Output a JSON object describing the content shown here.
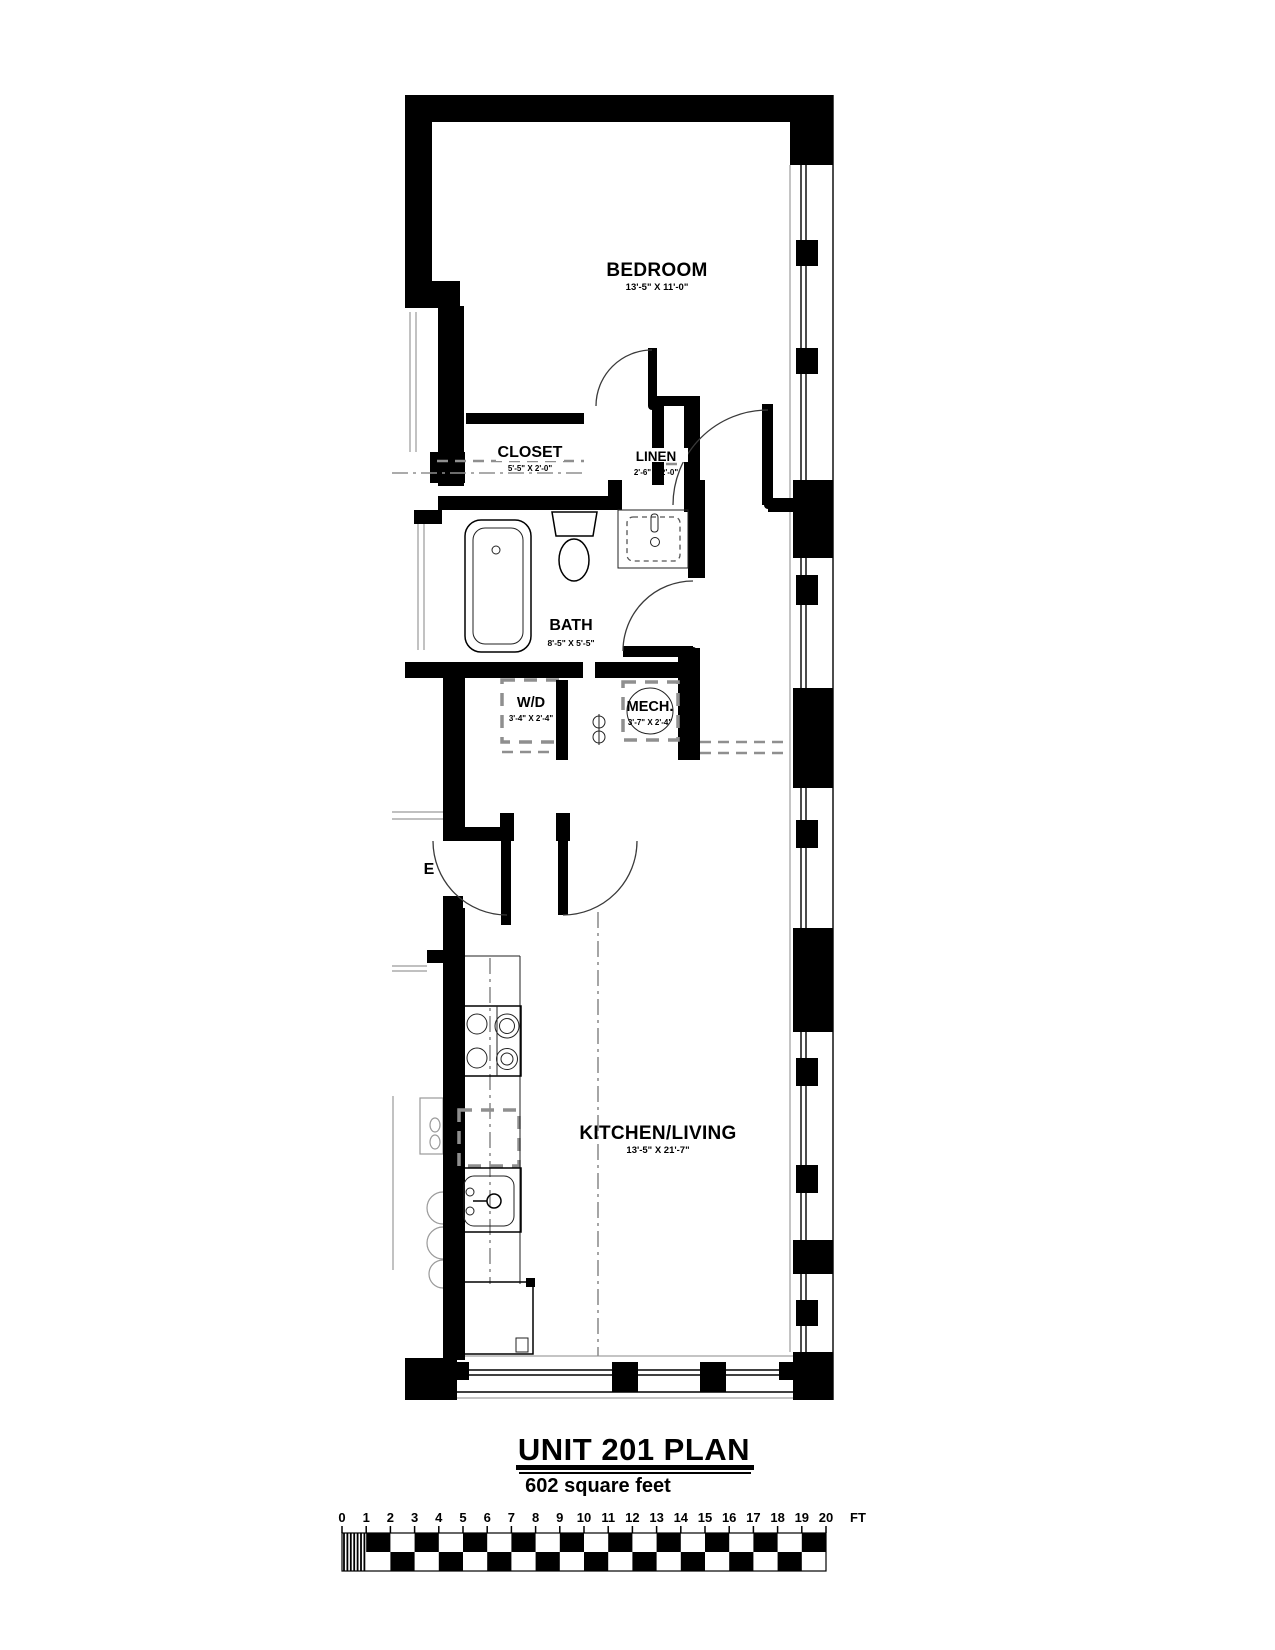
{
  "plan": {
    "rooms": [
      {
        "name": "BEDROOM",
        "dims": "13'-5\" X 11'-0\""
      },
      {
        "name": "CLOSET",
        "dims": "5'-5\" X 2'-0\""
      },
      {
        "name": "LINEN",
        "dims": "2'-6\" X 2'-0\""
      },
      {
        "name": "BATH",
        "dims": "8'-5\" X 5'-5\""
      },
      {
        "name": "W/D",
        "dims": "3'-4\" X 2'-4\""
      },
      {
        "name": "MECH.",
        "dims": "3'-7\" X 2'-4\""
      },
      {
        "name": "KITCHEN/LIVING",
        "dims": "13'-5\" X 21'-7\""
      }
    ],
    "entry_label": "E"
  },
  "title": {
    "main": "UNIT 201 PLAN",
    "subtitle": "602 square feet"
  },
  "scale_bar": {
    "ticks": [
      "0",
      "1",
      "2",
      "3",
      "4",
      "5",
      "6",
      "7",
      "8",
      "9",
      "10",
      "11",
      "12",
      "13",
      "14",
      "15",
      "16",
      "17",
      "18",
      "19",
      "20"
    ],
    "unit": "FT"
  },
  "colors": {
    "ink": "#000000",
    "paper": "#ffffff"
  }
}
